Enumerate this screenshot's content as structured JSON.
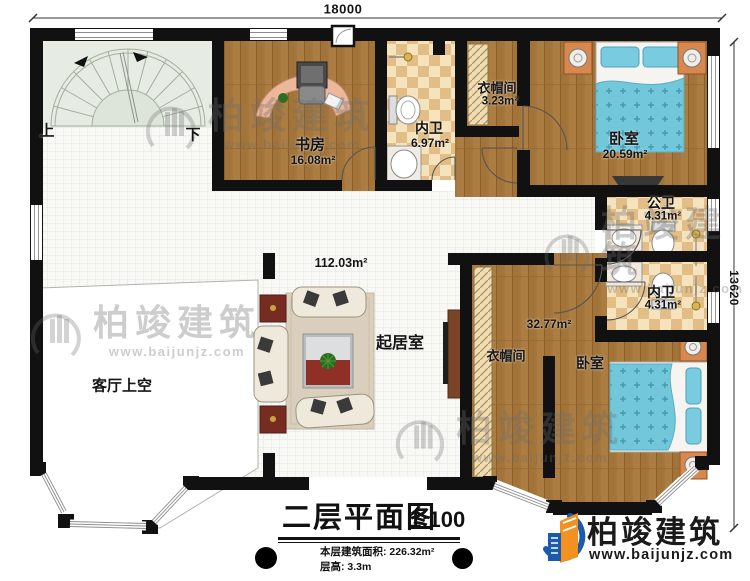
{
  "dimensions": {
    "top": "18000",
    "right": "13620"
  },
  "stairs": {
    "up_label": "上",
    "down_label": "下"
  },
  "rooms": {
    "study": {
      "name": "书房",
      "area": "16.08m²"
    },
    "ensuite_top": {
      "name": "内卫",
      "area": "6.97m²"
    },
    "closet_top": {
      "name": "衣帽间",
      "area": "3.23m²"
    },
    "bedroom_top": {
      "name": "卧室",
      "area": "20.59m²"
    },
    "public_bath": {
      "name": "公卫",
      "area": "4.31m²"
    },
    "ensuite_right": {
      "name": "内卫",
      "area": "4.31m²"
    },
    "living": {
      "name": "起居室",
      "area": "112.03m²"
    },
    "void": {
      "name": "客厅上空"
    },
    "closet_bottom": {
      "name": "衣帽间"
    },
    "bedroom_bottom": {
      "name": "卧室",
      "area": "32.77m²"
    }
  },
  "title_block": {
    "title": "二层平面图",
    "scale": "1:100",
    "area_label": "本层建筑面积:",
    "area_value": "226.32m²",
    "height_label": "层高:",
    "height_value": "3.3m"
  },
  "branding": {
    "company": "柏竣建筑",
    "website": "www.baijunjz.com"
  },
  "watermark": {
    "company": "柏竣建筑",
    "website": "www.baijunjz.com"
  },
  "colors": {
    "wall": "#111111",
    "wood_floor": "#ab7d42",
    "bath_tile_light": "#f5e3bd",
    "bath_tile_dark": "#e2bd85",
    "stair_floor": "#e6ebe3",
    "bed_cover": "#72c8da",
    "nightstand": "#d8884e",
    "logo_blue": "#1b5bad",
    "logo_orange": "#f39120"
  }
}
